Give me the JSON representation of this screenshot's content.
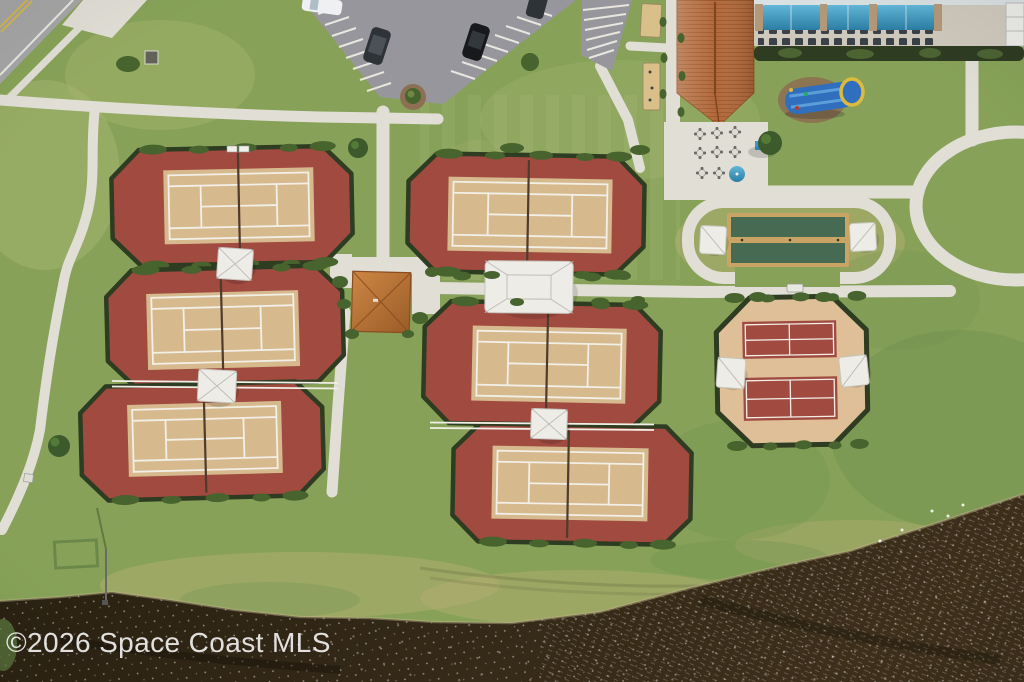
{
  "image": {
    "watermark": "©2026 Space Coast MLS",
    "description": "Aerial drone photo of a community recreation campus: six clay-colored tennis courts with white shade sails, a pickleball pad, shuffleboard courts, a clubhouse with blue pool cabanas and an inflatable water slide, a parking lot with cars, concrete walking paths, lawns and a dark pond along the bottom shoreline."
  },
  "scene": {
    "features": [
      {
        "name": "tennis-courts",
        "label": "Six tennis courts in two banks of three"
      },
      {
        "name": "pickleball-courts",
        "label": "Octagonal pickleball pad with shade sails"
      },
      {
        "name": "shuffleboard-courts",
        "label": "Two green shuffleboard lanes with end canopies"
      },
      {
        "name": "clubhouse",
        "label": "Clubhouse with terracotta tile roof"
      },
      {
        "name": "pool-cabanas",
        "label": "Blue pool-deck cabanas and lounge chairs"
      },
      {
        "name": "water-slide",
        "label": "Blue inflatable water slide on the lawn"
      },
      {
        "name": "central-pavilion",
        "label": "Square-roof pavilion at the court paths junction"
      },
      {
        "name": "parking-lot",
        "label": "Striped parking lot with four parked cars"
      },
      {
        "name": "walking-paths",
        "label": "Concrete walking paths and oval loop"
      },
      {
        "name": "pond",
        "label": "Dark pond water along the lower shoreline"
      },
      {
        "name": "road",
        "label": "Road with yellow center line at top-left corner"
      }
    ]
  },
  "colors": {
    "grass-base": "#87a258",
    "grass-light": "#a9b671",
    "grass-yellow": "#b3ad72",
    "grass-dark": "#6f9150",
    "water-dark": "#271f10",
    "water-mid": "#332817",
    "water-light": "#3d2f1a",
    "path": "#e0ded5",
    "road": "#a6a6a6",
    "road-yellow": "#d9b943",
    "asphalt": "#96969c",
    "court-red": "#a04a40",
    "court-tan": "#d7b98e",
    "line-white": "#f2efe7",
    "hedge": "#2e3c22",
    "bush": "#47632e",
    "net": "#4e3b2b",
    "sail": "#edece6",
    "roof-orange": "#b2693a",
    "roof-dark": "#8d4f25",
    "pavilion-light": "#cd8743",
    "pavilion-dark": "#9a5c28",
    "canopy-light": "#62b7d8",
    "canopy-dark": "#2b7da4",
    "shuffle-green": "#476b52",
    "shuffle-tan": "#c9a464",
    "pickle-tan": "#debf97",
    "slide-blue": "#2f6fbe",
    "slide-yellow": "#ddba3c",
    "mulch": "#8d7053",
    "deck": "#cfc9bd",
    "car-white": "#eef0f2",
    "car-dark": "#2e3338",
    "car-black": "#17191c",
    "watermark": "#fafafa"
  }
}
